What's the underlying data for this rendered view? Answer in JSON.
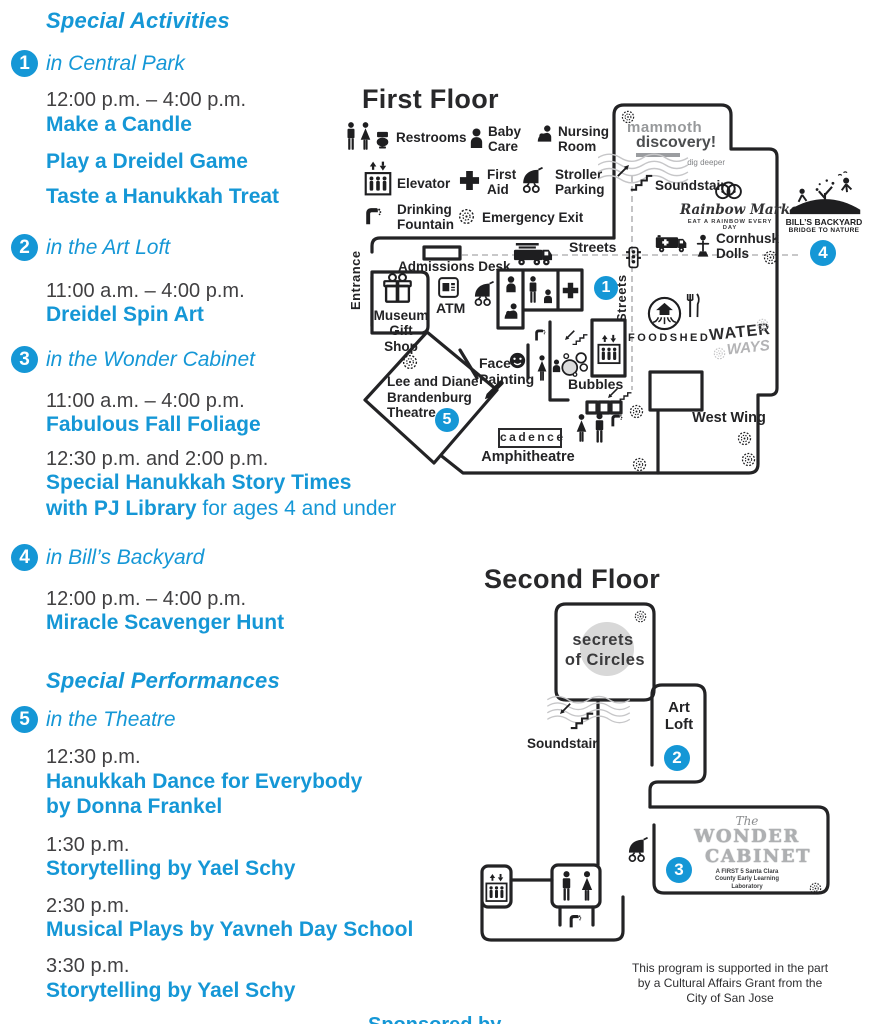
{
  "colors": {
    "accent_blue": "#1597d6",
    "ink": "#414042",
    "wall": "#232325"
  },
  "program": {
    "activities_heading": "Special Activities",
    "performances_heading": "Special Performances",
    "entries": [
      {
        "num": "1",
        "location": "in Central Park",
        "sessions": [
          {
            "time": "12:00 p.m. – 4:00 p.m.",
            "titles": [
              "Make a Candle",
              "Play a Dreidel Game",
              "Taste a Hanukkah Treat"
            ]
          }
        ]
      },
      {
        "num": "2",
        "location": "in the Art Loft",
        "sessions": [
          {
            "time": "11:00 a.m. – 4:00 p.m.",
            "titles": [
              "Dreidel Spin Art"
            ]
          }
        ]
      },
      {
        "num": "3",
        "location": "in the Wonder Cabinet",
        "sessions": [
          {
            "time": "11:00 a.m. – 4:00 p.m.",
            "titles": [
              "Fabulous Fall Foliage"
            ]
          },
          {
            "time": "12:30 p.m. and 2:00 p.m.",
            "title_line1": "Special Hanukkah Story Times",
            "title_bold": "with PJ Library",
            "title_regular": "for ages 4 and under"
          }
        ]
      },
      {
        "num": "4",
        "location": "in Bill’s Backyard",
        "sessions": [
          {
            "time": "12:00 p.m. – 4:00 p.m.",
            "titles": [
              "Miracle Scavenger Hunt"
            ]
          }
        ]
      },
      {
        "num": "5",
        "location": "in the Theatre",
        "sessions": [
          {
            "time": "12:30 p.m.",
            "titles": [
              "Hanukkah Dance for Everybody",
              "by Donna Frankel"
            ]
          },
          {
            "time": "1:30 p.m.",
            "titles": [
              "Storytelling by Yael Schy"
            ]
          },
          {
            "time": "2:30 p.m.",
            "titles": [
              "Musical Plays by Yavneh Day School"
            ]
          },
          {
            "time": "3:30 p.m.",
            "titles": [
              "Storytelling by Yael Schy"
            ]
          }
        ]
      }
    ]
  },
  "first_floor": {
    "heading": "First Floor",
    "legend": [
      {
        "icon": "restrooms-icon",
        "label": "Restrooms"
      },
      {
        "icon": "baby-care-icon",
        "label": "Baby Care"
      },
      {
        "icon": "nursing-room-icon",
        "label": "Nursing Room"
      },
      {
        "icon": "elevator-icon",
        "label": "Elevator"
      },
      {
        "icon": "first-aid-icon",
        "label": "First Aid"
      },
      {
        "icon": "stroller-parking-icon",
        "label": "Stroller Parking"
      },
      {
        "icon": "drinking-fountain-icon",
        "label": "Drinking Fountain"
      },
      {
        "icon": "emergency-exit-icon",
        "label": "Emergency Exit"
      }
    ],
    "labels": {
      "entrance": "Entrance",
      "admissions_desk": "Admissions Desk",
      "museum_gift_shop": "Museum Gift Shop",
      "atm": "ATM",
      "streets_horizontal": "Streets",
      "streets_vertical": "Streets",
      "soundstair": "Soundstair",
      "cornhusk_dolls": "Cornhusk Dolls",
      "foodshed": "FOODSHED",
      "face_painting": "Face Painting",
      "bubbles": "Bubbles",
      "theatre": "Lee and Diane Brandenburg Theatre",
      "cadence": "cadence",
      "amphitheatre": "Amphitheatre",
      "west_wing": "West Wing"
    },
    "logos": {
      "mammoth_line1": "mammoth",
      "mammoth_line2": "discovery!",
      "mammoth_tagline": "dig deeper",
      "rainbow_market": "Rainbow Market",
      "rainbow_market_tagline": "EAT A RAINBOW EVERY DAY",
      "bills_backyard_line1": "BILL’S BACKYARD",
      "bills_backyard_line2": "BRIDGE TO NATURE",
      "waterways_line1": "WATER",
      "waterways_line2": "WAYS"
    },
    "map_icons": [
      "fire-truck-icon",
      "traffic-light-icon",
      "ambulance-icon",
      "cornhusk-doll-icon",
      "gift-box-icon",
      "atm-icon",
      "stroller-icon",
      "elevator-icon",
      "first-aid-icon",
      "nursing-icon",
      "man-icon",
      "woman-icon",
      "baby-icon",
      "drinking-fountain-icon",
      "emergency-exit-icon",
      "stairs-icon",
      "bubbles-icon",
      "face-painting-icon",
      "paintbrush-icon",
      "fork-knife-icon",
      "foodshed-logo-icon",
      "amphitheatre-seats"
    ]
  },
  "second_floor": {
    "heading": "Second Floor",
    "labels": {
      "soundstair": "Soundstair",
      "art_loft": "Art Loft",
      "secrets_line1": "secrets",
      "secrets_line2": "of Circles",
      "wonder_the": "The",
      "wonder_line1": "WONDER",
      "wonder_line2": "CABINET",
      "wonder_tagline": "A FIRST 5 Santa Clara County Early Learning Laboratory"
    },
    "map_icons": [
      "stairs-icon",
      "stroller-icon",
      "elevator-icon",
      "man-icon",
      "woman-icon",
      "drinking-fountain-icon",
      "emergency-exit-icon"
    ]
  },
  "footer": {
    "line1": "This program is supported in the part",
    "line2": "by a Cultural Affairs Grant from the",
    "line3": "City of San Jose"
  },
  "partial_bottom_text": "Sponsored by"
}
